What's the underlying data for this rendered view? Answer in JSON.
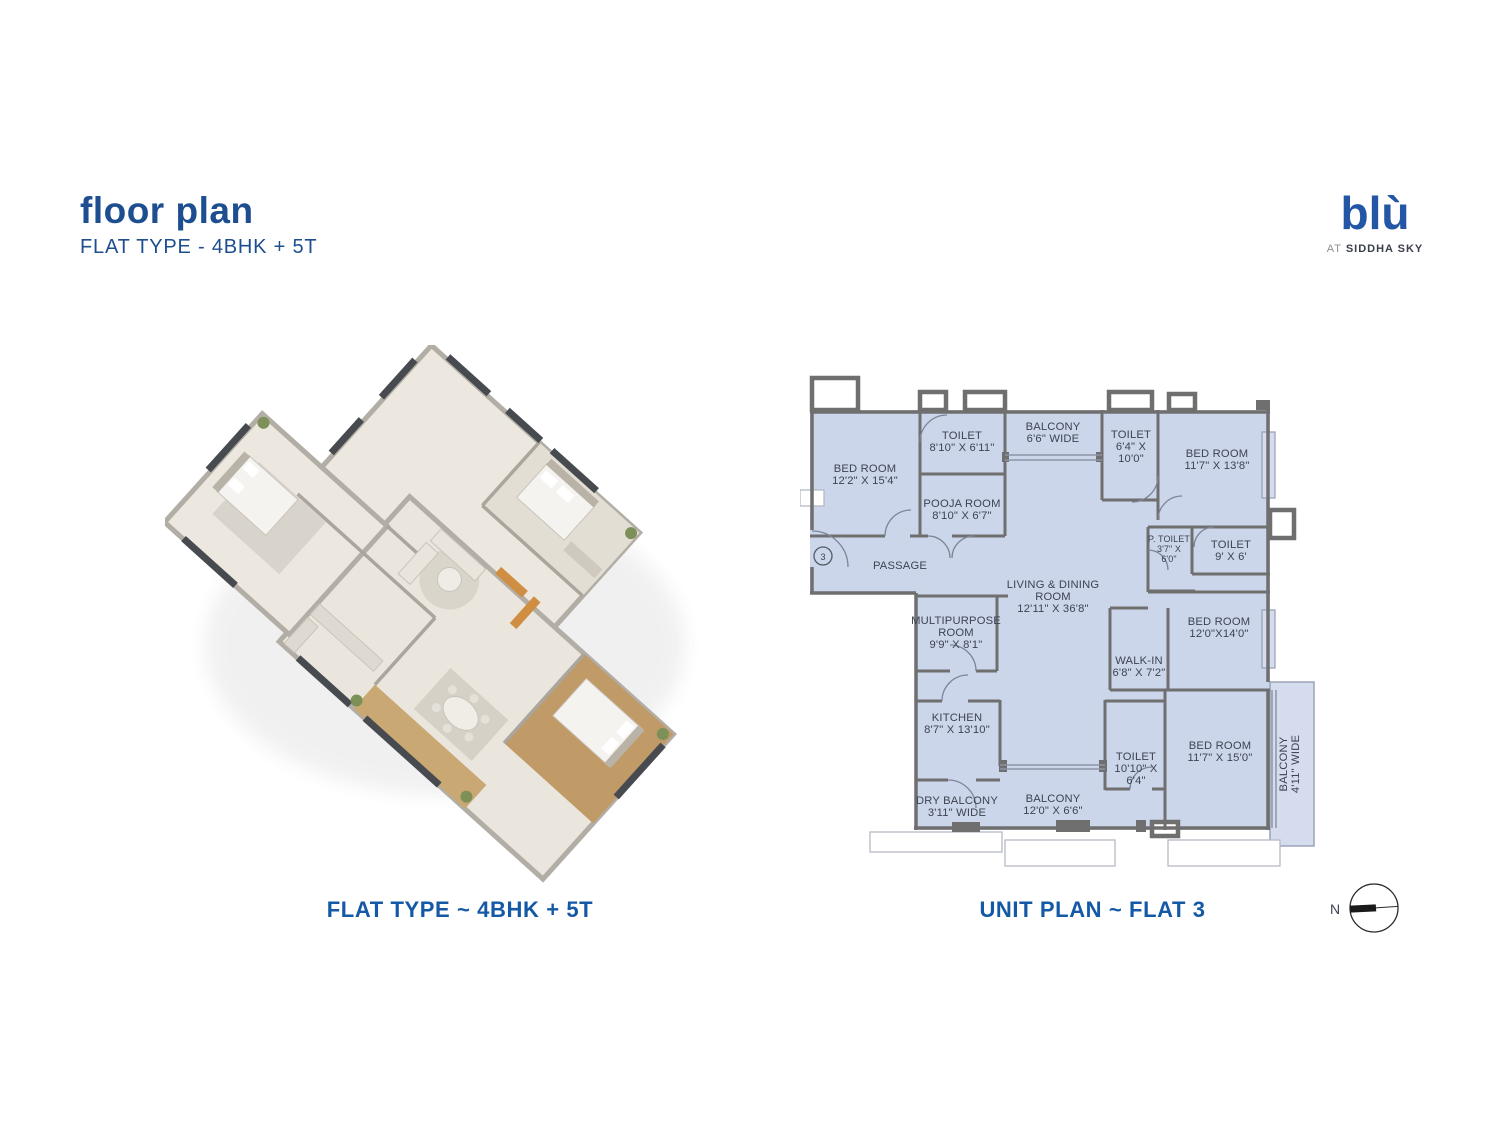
{
  "header": {
    "title": "floor plan",
    "subtitle": "FLAT TYPE - 4BHK + 5T"
  },
  "logo": {
    "name": "blù",
    "tagline_prefix": "AT",
    "tagline_brand": "SIDDHA SKY"
  },
  "captions": {
    "left": "FLAT TYPE ~ 4BHK + 5T",
    "right": "UNIT PLAN ~ FLAT 3"
  },
  "compass": {
    "label": "N"
  },
  "colors": {
    "accent_blue": "#1d4e8f",
    "caption_blue": "#1459a6",
    "plan_fill": "#ccd6ea",
    "plan_wall": "#6f6f6f",
    "plan_text": "#3d4352"
  },
  "unit_plan": {
    "entrance_label": "3",
    "rooms": [
      {
        "id": "bedroom-1",
        "lines": [
          "BED ROOM",
          "12'2\" X 15'4\""
        ]
      },
      {
        "id": "toilet-1",
        "lines": [
          "TOILET",
          "8'10\" X 6'11\""
        ]
      },
      {
        "id": "pooja-room",
        "lines": [
          "POOJA ROOM",
          "8'10\" X 6'7\""
        ]
      },
      {
        "id": "balcony-top",
        "lines": [
          "BALCONY",
          "6'6\" WIDE"
        ]
      },
      {
        "id": "toilet-2",
        "lines": [
          "TOILET",
          "6'4\" X",
          "10'0\""
        ]
      },
      {
        "id": "bedroom-2",
        "lines": [
          "BED ROOM",
          "11'7\" X 13'8\""
        ]
      },
      {
        "id": "p-toilet",
        "lines": [
          "P. TOILET",
          "3'7\" X",
          "6'0\""
        ]
      },
      {
        "id": "toilet-3",
        "lines": [
          "TOILET",
          "9' X 6'"
        ]
      },
      {
        "id": "passage",
        "lines": [
          "PASSAGE"
        ]
      },
      {
        "id": "living-dining",
        "lines": [
          "LIVING & DINING",
          "ROOM",
          "12'11\" X 36'8\""
        ]
      },
      {
        "id": "multipurpose",
        "lines": [
          "MULTIPURPOSE",
          "ROOM",
          "9'9\" X 8'1\""
        ]
      },
      {
        "id": "walk-in",
        "lines": [
          "WALK-IN",
          "6'8\" X 7'2\""
        ]
      },
      {
        "id": "bedroom-3",
        "lines": [
          "BED ROOM",
          "12'0\"X14'0\""
        ]
      },
      {
        "id": "kitchen",
        "lines": [
          "KITCHEN",
          "8'7\" X 13'10\""
        ]
      },
      {
        "id": "toilet-4",
        "lines": [
          "TOILET",
          "10'10\" X",
          "6'4\""
        ]
      },
      {
        "id": "bedroom-4",
        "lines": [
          "BED ROOM",
          "11'7\" X 15'0\""
        ]
      },
      {
        "id": "balcony-right",
        "lines": [
          "BALCONY",
          "4'11\" WIDE"
        ]
      },
      {
        "id": "dry-balcony",
        "lines": [
          "DRY BALCONY",
          "3'11\" WIDE"
        ]
      },
      {
        "id": "balcony-bottom",
        "lines": [
          "BALCONY",
          "12'0\" X 6'6\""
        ]
      }
    ]
  }
}
